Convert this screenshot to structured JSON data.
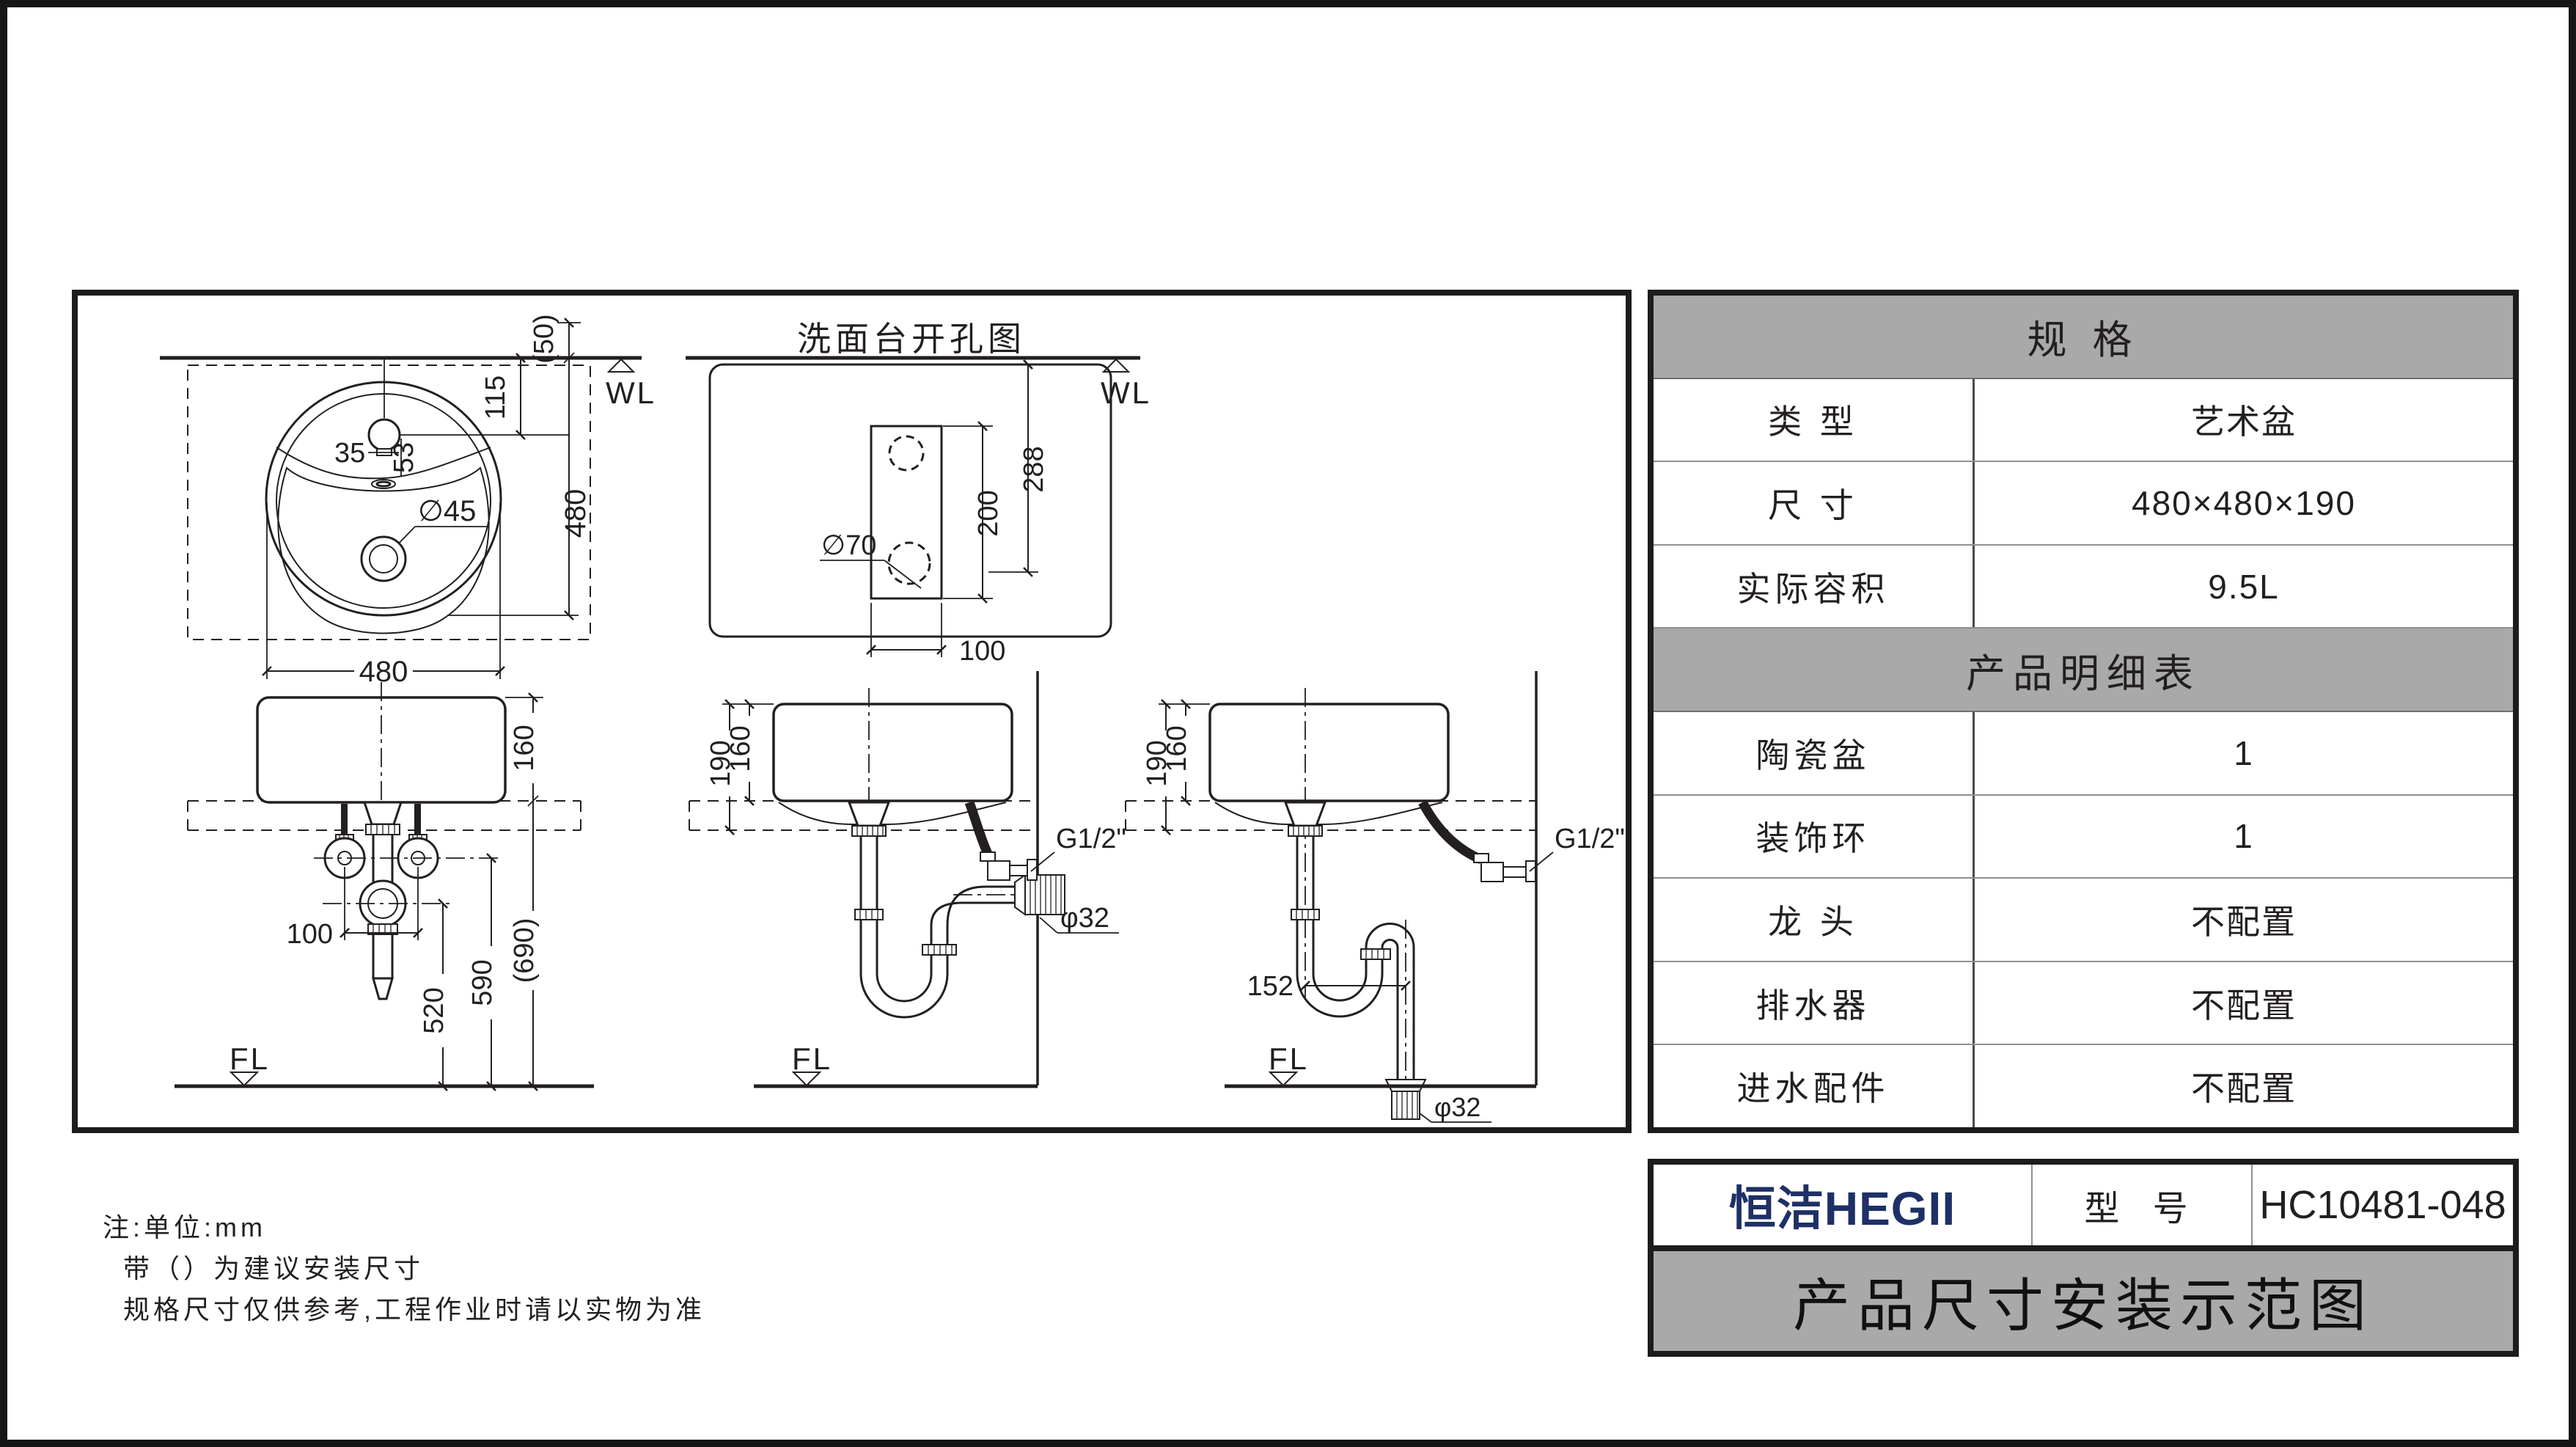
{
  "drawing": {
    "views": {
      "top": {
        "wl": "WL",
        "dims": {
          "d50": "(50)",
          "d115": "115",
          "d480v": "480",
          "d480h": "480",
          "d35": "35",
          "d53": "53",
          "drain": "∅45"
        }
      },
      "cutout": {
        "title": "洗面台开孔图",
        "wl": "WL",
        "dims": {
          "d70": "∅70",
          "d200": "200",
          "d288": "288",
          "d100": "100"
        }
      },
      "front": {
        "fl": "FL",
        "dims": {
          "d160": "160",
          "d100": "100",
          "d520": "520",
          "d590": "590",
          "d690": "(690)"
        }
      },
      "side_wall": {
        "fl": "FL",
        "dims": {
          "d190": "190",
          "d160": "160",
          "inlet": "G1/2\"",
          "drain": "φ32"
        }
      },
      "side_floor": {
        "fl": "FL",
        "dims": {
          "d190": "190",
          "d160": "160",
          "d152": "152",
          "inlet": "G1/2\"",
          "drain": "φ32"
        }
      }
    }
  },
  "spec_table": {
    "header": "规  格",
    "rows": [
      {
        "label": "类  型",
        "value": "艺术盆"
      },
      {
        "label": "尺  寸",
        "value": "480×480×190"
      },
      {
        "label": "实际容积",
        "value": "9.5L"
      }
    ],
    "detail_header": "产品明细表",
    "detail_rows": [
      {
        "label": "陶瓷盆",
        "value": "1"
      },
      {
        "label": "装饰环",
        "value": "1"
      },
      {
        "label": "龙  头",
        "value": "不配置"
      },
      {
        "label": "排水器",
        "value": "不配置"
      },
      {
        "label": "进水配件",
        "value": "不配置"
      }
    ]
  },
  "title_block": {
    "brand": "恒洁HEGII",
    "brand_color": "#1e3066",
    "model_label": "型 号",
    "model_value": "HC10481-048",
    "banner": "产品尺寸安装示范图"
  },
  "notes": {
    "line1": "注:单位:mm",
    "line2": "带（）为建议安装尺寸",
    "line3": "规格尺寸仅供参考,工程作业时请以实物为准"
  },
  "colors": {
    "ink": "#231f20",
    "table_gray": "#a9a9a9"
  }
}
